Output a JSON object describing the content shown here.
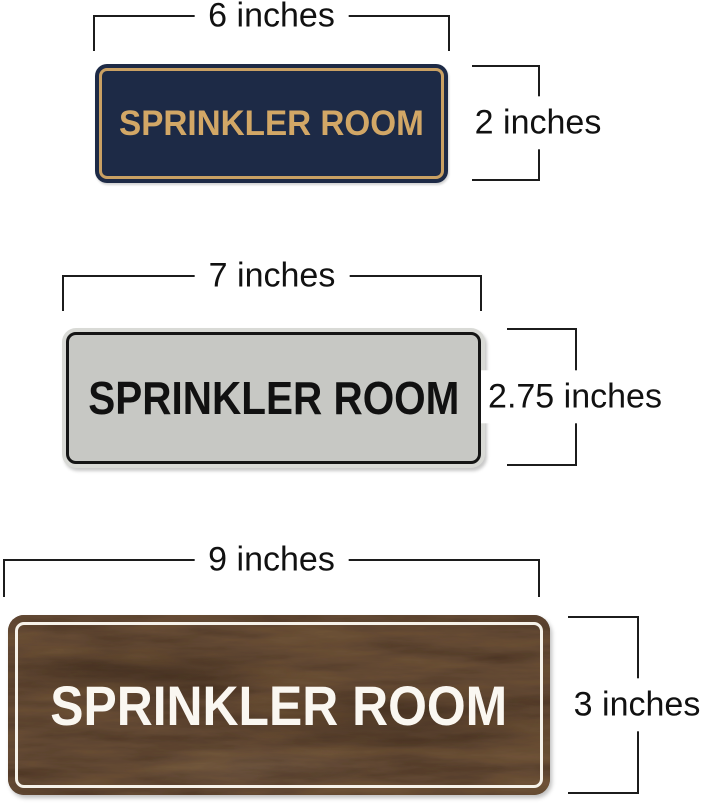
{
  "diagram": {
    "description": "Three Sprinkler Room door signs shown with width and height dimension callouts",
    "annotation_color": "#1c1c1c"
  },
  "signs": [
    {
      "style": "navy-gold",
      "label": "SPRINKLER ROOM",
      "width_label": "6 inches",
      "height_label": "2 inches",
      "colors": {
        "background": "#1d2a46",
        "ring": "#c9a063",
        "text": "#d2a766"
      }
    },
    {
      "style": "silver-black",
      "label": "SPRINKLER ROOM",
      "width_label": "7 inches",
      "height_label": "2.75 inches",
      "colors": {
        "rim": "#d9dad6",
        "background": "#c7c8c4",
        "ring": "#151515",
        "text": "#111111"
      }
    },
    {
      "style": "walnut-white",
      "label": "SPRINKLER ROOM",
      "width_label": "9 inches",
      "height_label": "3 inches",
      "colors": {
        "background": "#5d4731",
        "ring": "#f6f2ea",
        "text": "#faf7f1"
      }
    }
  ]
}
